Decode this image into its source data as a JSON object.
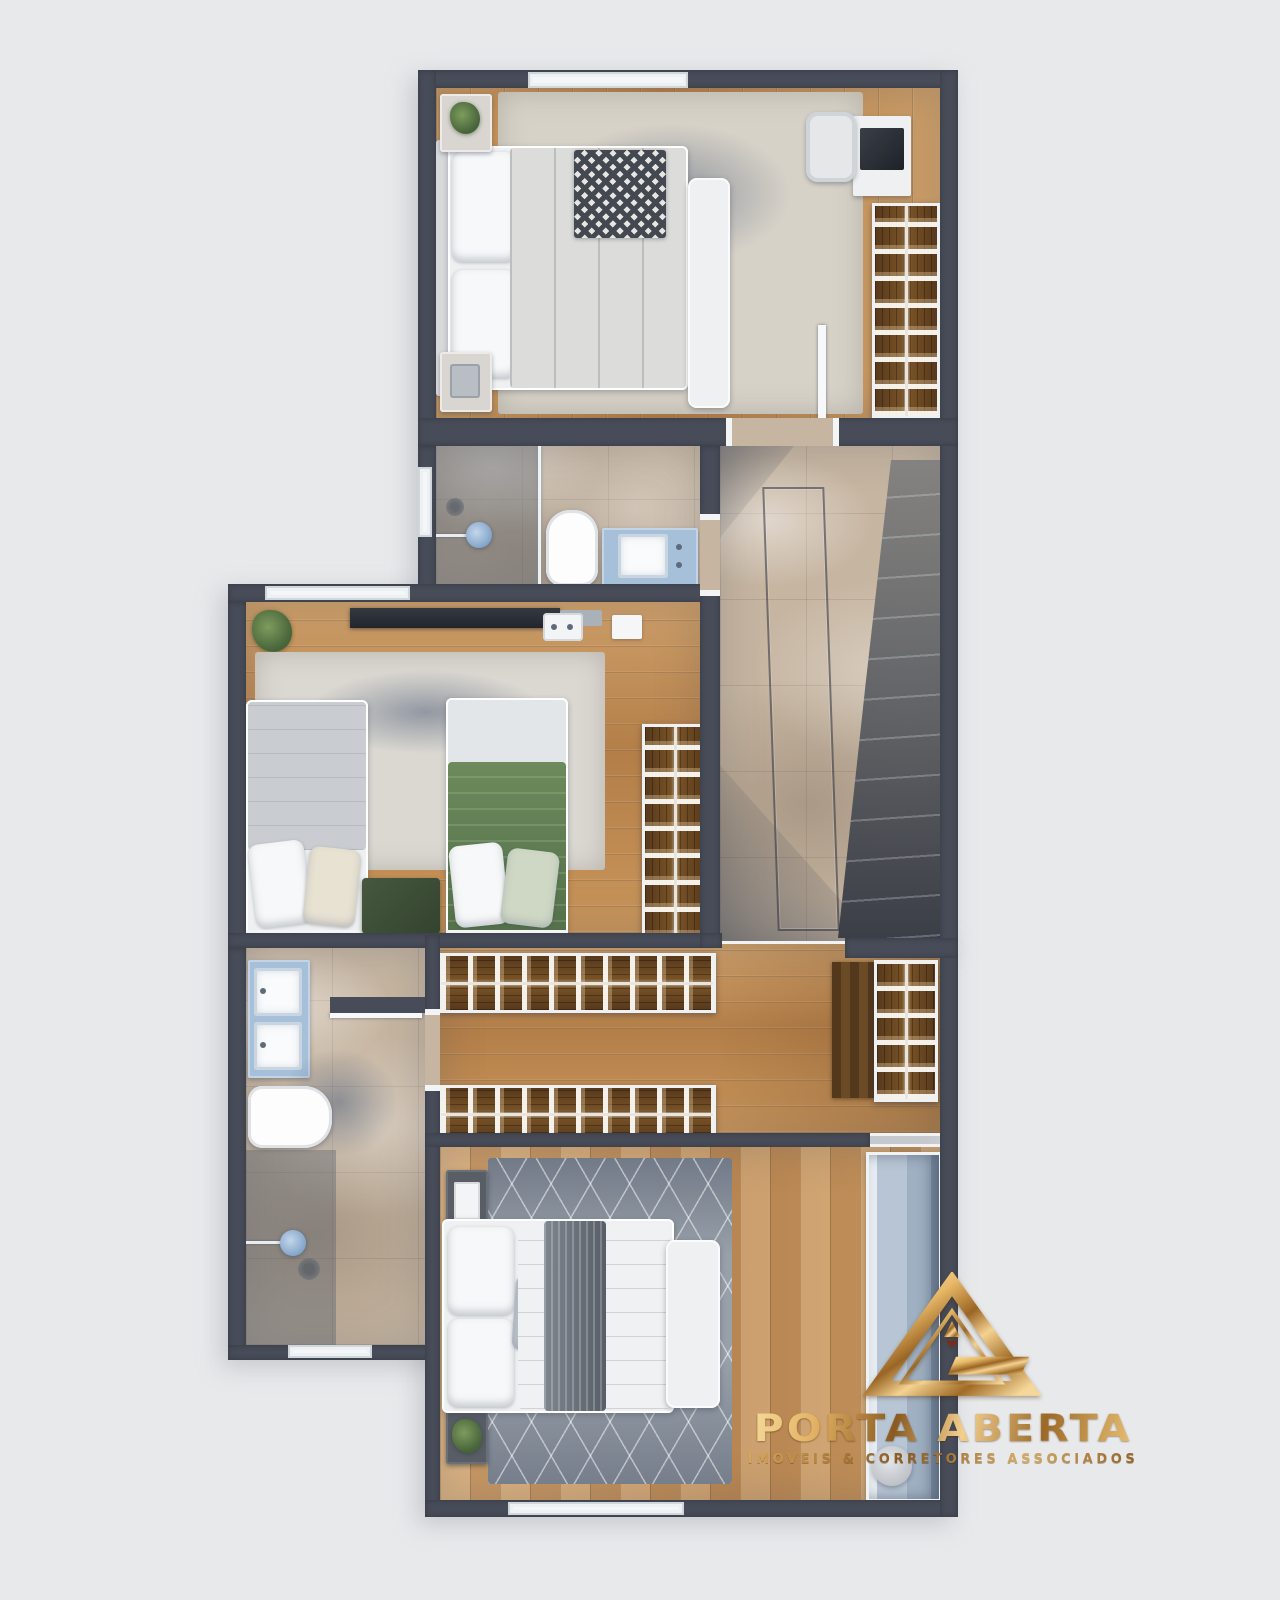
{
  "watermark": {
    "brand": "PORTA ABERTA",
    "tagline": "IMOVEIS & CORRETORES ASSOCIADOS",
    "logo_icon": "gold-triangle-logo",
    "gold_light": "#f6d894",
    "gold_mid": "#c18a3e",
    "gold_dark": "#7e4f16",
    "accent_red": "#7c2a1c"
  },
  "palette": {
    "page_background": "#e8e9eb",
    "wall": "#474c58",
    "wall_trim": "#f2f4f5",
    "wood_floor": "#c2905a",
    "wood_floor_light": "#d2a470",
    "marble_floor": "#c6b5a1",
    "stair_shadow": "#3f4754",
    "rug_beige": "#d7d2c8",
    "rug_twin": "#dbd8d2",
    "rug_gray": "#98a0aa",
    "bedding_white": "#eef0f1",
    "bedding_green": "#607c51",
    "vanity_blue": "#a6c0da",
    "closet_wood": "#5f3f20",
    "glass_blue": "#9db9d8"
  }
}
